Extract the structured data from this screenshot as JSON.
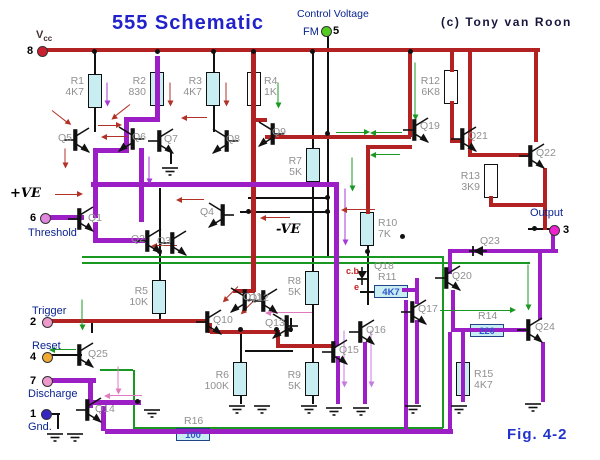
{
  "title": "555 Schematic",
  "copyright": "(c) Tony van Roon",
  "figure": "Fig. 4-2",
  "annotations": {
    "plus_ve": "+VE",
    "minus_ve": "-VE",
    "cb": "c.b",
    "e": "e",
    "control_voltage": "Control Voltage"
  },
  "pins": [
    {
      "num": "8",
      "label": "Vcc"
    },
    {
      "num": "5",
      "label": "FM"
    },
    {
      "num": "6",
      "label": "Threshold"
    },
    {
      "num": "2",
      "label": "Trigger"
    },
    {
      "num": "4",
      "label": "Reset"
    },
    {
      "num": "7",
      "label": "Discharge"
    },
    {
      "num": "1",
      "label": "Gnd."
    },
    {
      "num": "3",
      "label": "Output"
    }
  ],
  "resistors": [
    {
      "id": "R1",
      "value": "4K7"
    },
    {
      "id": "R2",
      "value": "830"
    },
    {
      "id": "R3",
      "value": "4K7"
    },
    {
      "id": "R4",
      "value": "1K"
    },
    {
      "id": "R5",
      "value": "10K"
    },
    {
      "id": "R6",
      "value": "100K"
    },
    {
      "id": "R7",
      "value": "5K"
    },
    {
      "id": "R8",
      "value": "5K"
    },
    {
      "id": "R9",
      "value": "5K"
    },
    {
      "id": "R10",
      "value": "7K"
    },
    {
      "id": "R11",
      "value": "4K7"
    },
    {
      "id": "R12",
      "value": "6K8"
    },
    {
      "id": "R13",
      "value": "3K9"
    },
    {
      "id": "R14",
      "value": "220"
    },
    {
      "id": "R15",
      "value": "4K7"
    },
    {
      "id": "R16",
      "value": "100"
    }
  ],
  "transistors": [
    "Q1",
    "Q2",
    "Q3",
    "Q4",
    "Q5",
    "Q6",
    "Q7",
    "Q8",
    "Q9",
    "Q10",
    "Q11",
    "Q12",
    "Q13",
    "Q14",
    "Q15",
    "Q16",
    "Q17",
    "Q19",
    "Q20",
    "Q21",
    "Q22",
    "Q24",
    "Q25"
  ],
  "diodes": [
    "Q18",
    "Q23"
  ],
  "colors": {
    "wire_red": "#b22222",
    "wire_purple": "#9b1fc4",
    "wire_green": "#1a9922",
    "wire_black": "#111111",
    "resistor_fill": "#c8eef2",
    "title_blue": "#2222cc"
  }
}
